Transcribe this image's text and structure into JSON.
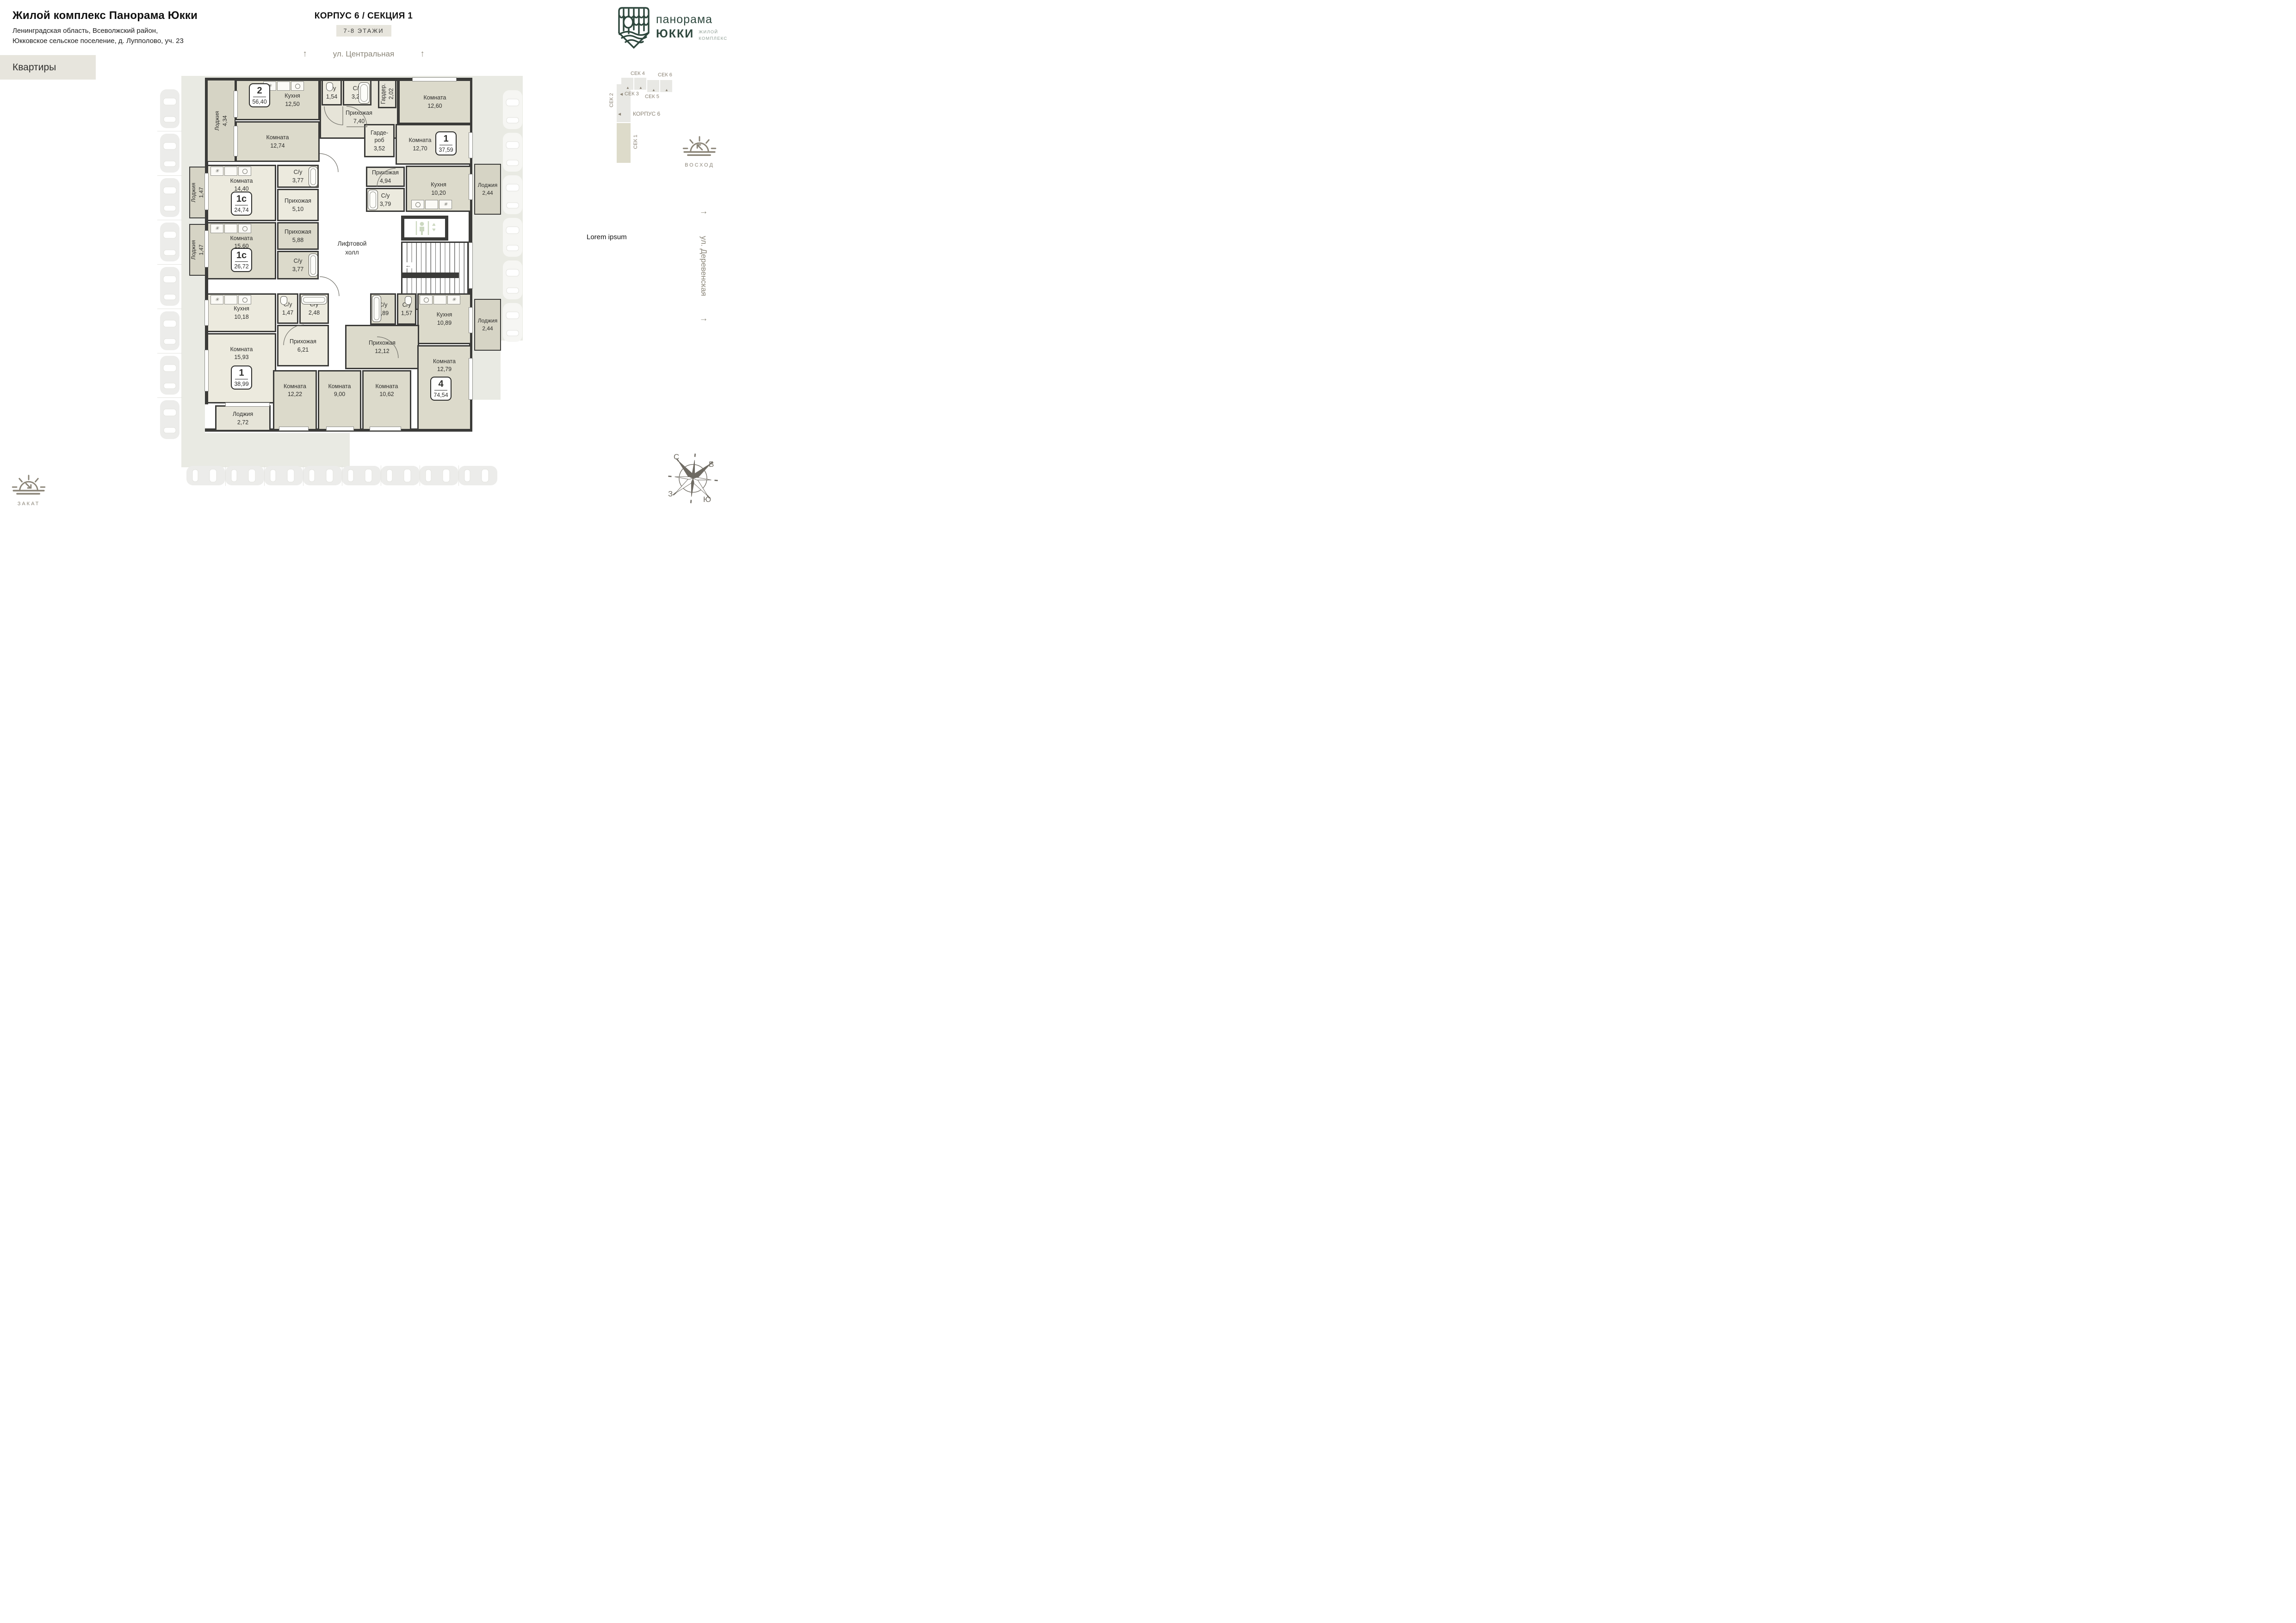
{
  "header": {
    "title": "Жилой комплекс Панорама Юкки",
    "address1": "Ленинградская область, Всеволжский район,",
    "address2": "Юкковское сельское поселение, д. Лупполово, уч. 23",
    "apartments_tab": "Квартиры"
  },
  "plan_header": {
    "title": "КОРПУС 6 / СЕКЦИЯ 1",
    "floors": "7-8 ЭТАЖИ"
  },
  "streets": {
    "top": "ул. Центральная",
    "right": "ул. Деревенская"
  },
  "logo": {
    "brand_top": "панорама",
    "brand_bottom": "ЮККИ",
    "tag1": "ЖИЛОЙ",
    "tag2": "КОМПЛЕКС"
  },
  "section_map": {
    "korpus": "КОРПУС 6",
    "s1": "СЕК 1",
    "s2": "СЕК 2",
    "s3": "СЕК 3",
    "s4": "СЕК 4",
    "s5": "СЕК 5",
    "s6": "СЕК 6"
  },
  "sun": {
    "sunrise": "ВОСХОД",
    "sunset": "ЗАКАТ"
  },
  "compass": {
    "n": "С",
    "e": "В",
    "w": "З",
    "s": "Ю"
  },
  "note": "Lorem ipsum",
  "lift": {
    "line1": "Лифтовой",
    "line2": "холл"
  },
  "badges": {
    "b2": {
      "num": "2",
      "area": "56,40"
    },
    "b3759": {
      "num": "1",
      "area": "37,59"
    },
    "b2474": {
      "num": "1с",
      "area": "24,74"
    },
    "b2672": {
      "num": "1с",
      "area": "26,72"
    },
    "b3899": {
      "num": "1",
      "area": "38,99"
    },
    "b7454": {
      "num": "4",
      "area": "74,54"
    }
  },
  "rooms": {
    "loggia_434": {
      "name": "Лоджия",
      "area": "4,34"
    },
    "kitchen_1250": {
      "name": "Кухня",
      "area": "12,50"
    },
    "room_1274": {
      "name": "Комната",
      "area": "12,74"
    },
    "hall_740": {
      "name": "Прихожая",
      "area": "7,40"
    },
    "su_154": {
      "name": "С/у",
      "area": "1,54"
    },
    "su_326": {
      "name": "С/у",
      "area": "3,26"
    },
    "garder_202": {
      "name": "Гардер.",
      "area": "2,02"
    },
    "room_1260": {
      "name": "Комната",
      "area": "12,60"
    },
    "garderob_352": {
      "name": "Гарде- роб",
      "area": "3,52"
    },
    "room_1270": {
      "name": "Комната",
      "area": "12,70"
    },
    "hall_494": {
      "name": "Прихожая",
      "area": "4,94"
    },
    "su_379": {
      "name": "С/у",
      "area": "3,79"
    },
    "kitchen_1020": {
      "name": "Кухня",
      "area": "10,20"
    },
    "loggia_244a": {
      "name": "Лоджия",
      "area": "2,44"
    },
    "loggia_147a": {
      "name": "Лоджия",
      "area": "1,47"
    },
    "room_1440": {
      "name": "Комната",
      "area": "14,40"
    },
    "su_377a": {
      "name": "С/у",
      "area": "3,77"
    },
    "hall_510": {
      "name": "Прихожая",
      "area": "5,10"
    },
    "loggia_147b": {
      "name": "Лоджия",
      "area": "1,47"
    },
    "room_1560": {
      "name": "Комната",
      "area": "15,60"
    },
    "hall_588": {
      "name": "Прихожая",
      "area": "5,88"
    },
    "su_377b": {
      "name": "С/у",
      "area": "3,77"
    },
    "kitchen_1018": {
      "name": "Кухня",
      "area": "10,18"
    },
    "su_147": {
      "name": "С/у",
      "area": "1,47"
    },
    "su_248": {
      "name": "С/у",
      "area": "2,48"
    },
    "hall_621": {
      "name": "Прихожая",
      "area": "6,21"
    },
    "room_1593": {
      "name": "Комната",
      "area": "15,93"
    },
    "loggia_272": {
      "name": "Лоджия",
      "area": "2,72"
    },
    "room_1222": {
      "name": "Комната",
      "area": "12,22"
    },
    "room_900": {
      "name": "Комната",
      "area": "9,00"
    },
    "room_1062": {
      "name": "Комната",
      "area": "10,62"
    },
    "su_289": {
      "name": "С/у",
      "area": "2,89"
    },
    "su_157": {
      "name": "С/у",
      "area": "1,57"
    },
    "kitchen_1089": {
      "name": "Кухня",
      "area": "10,89"
    },
    "loggia_244b": {
      "name": "Лоджия",
      "area": "2,44"
    },
    "hall_1212": {
      "name": "Прихожая",
      "area": "12,12"
    },
    "room_1279": {
      "name": "Комната",
      "area": "12,79"
    }
  }
}
